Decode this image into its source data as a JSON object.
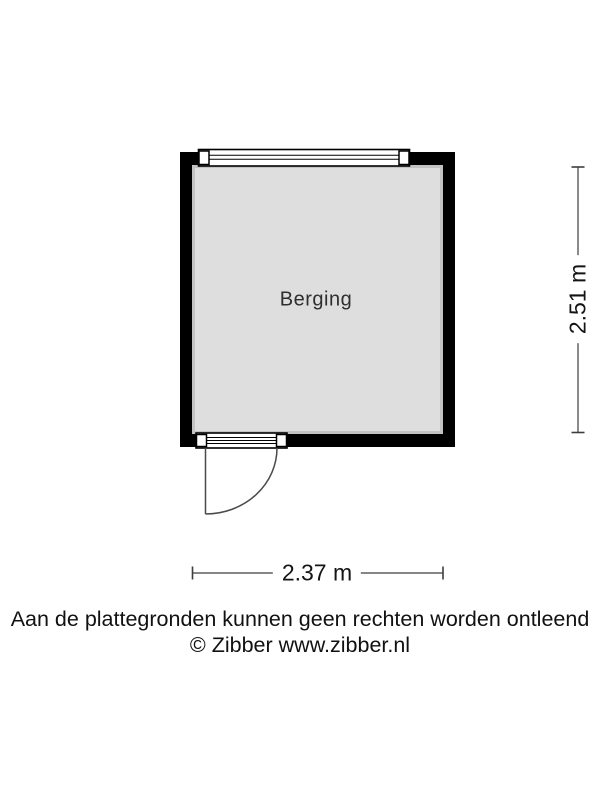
{
  "floorplan": {
    "room_label": "Berging",
    "dim_width_label": "2.37 m",
    "dim_height_label": "2.51 m"
  },
  "footer": {
    "disclaimer": "Aan de plattegronden kunnen geen rechten worden ontleend",
    "copyright": "© Zibber www.zibber.nl"
  },
  "colors": {
    "wall": "#000000",
    "floor": "#dedede",
    "frame_white": "#ffffff",
    "door_line": "#4a4a4a",
    "dimension_line": "#3d3d3d",
    "background": "#ffffff"
  }
}
